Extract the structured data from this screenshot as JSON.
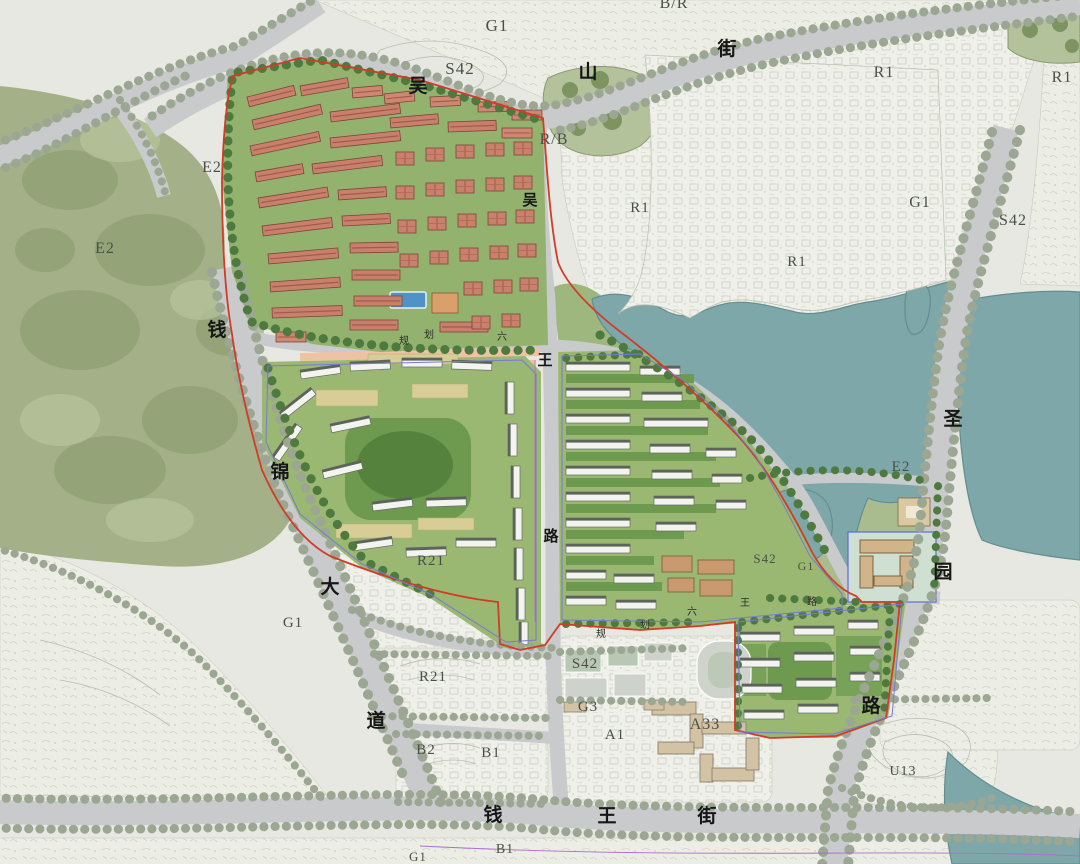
{
  "map": {
    "streets": {
      "top": "吴山街",
      "left": "钱锦大道",
      "bottom": "钱王街",
      "right": "圣园路",
      "central": "吴王路",
      "internal_prefix": "规划",
      "internal": "六王路"
    },
    "colors": {
      "water": "#7ea7a9",
      "water_edge": "#628e91",
      "hill_green": "#a4b188",
      "hill_dark": "#87996c",
      "dev_green": "#92b26e",
      "courtyard_green": "#6d9a4f",
      "tree_dark": "#4e7a3f",
      "tree_road": "#9ba792",
      "red_roof": "#c8806c",
      "red_roof_dark": "#7c4537",
      "white_building": "#f3f4f0",
      "slab_edge": "#5c635a",
      "road": "#c9cacc",
      "fabric": "#eceee6",
      "salmon_road": "#efc2a3",
      "tan_building": "#d2bc93",
      "boundary_red": "#d23b28",
      "parcel_blue": "#7878d8",
      "parcel_magenta": "#b06ad0",
      "pool_blue": "#4f92c8"
    }
  },
  "zone_labels": [
    {
      "text": "G1",
      "x": 497,
      "y": 31,
      "fs": 17
    },
    {
      "text": "S42",
      "x": 460,
      "y": 74,
      "fs": 17
    },
    {
      "text": "B/R",
      "x": 674,
      "y": 8,
      "fs": 16
    },
    {
      "text": "R/B",
      "x": 554,
      "y": 144,
      "fs": 16
    },
    {
      "text": "R1",
      "x": 640,
      "y": 212,
      "fs": 15
    },
    {
      "text": "R1",
      "x": 797,
      "y": 266,
      "fs": 15
    },
    {
      "text": "R1",
      "x": 884,
      "y": 77,
      "fs": 16
    },
    {
      "text": "R1",
      "x": 1062,
      "y": 82,
      "fs": 16
    },
    {
      "text": "G1",
      "x": 920,
      "y": 207,
      "fs": 16
    },
    {
      "text": "S42",
      "x": 1013,
      "y": 225,
      "fs": 16
    },
    {
      "text": "E2",
      "x": 212,
      "y": 172,
      "fs": 16
    },
    {
      "text": "E2",
      "x": 105,
      "y": 253,
      "fs": 16
    },
    {
      "text": "E2",
      "x": 901,
      "y": 471,
      "fs": 15
    },
    {
      "text": "R21",
      "x": 431,
      "y": 565,
      "fs": 15
    },
    {
      "text": "R21",
      "x": 433,
      "y": 681,
      "fs": 15
    },
    {
      "text": "G1",
      "x": 293,
      "y": 627,
      "fs": 15
    },
    {
      "text": "B2",
      "x": 426,
      "y": 754,
      "fs": 15
    },
    {
      "text": "B1",
      "x": 491,
      "y": 757,
      "fs": 15
    },
    {
      "text": "B1",
      "x": 505,
      "y": 853,
      "fs": 14
    },
    {
      "text": "G1",
      "x": 418,
      "y": 861,
      "fs": 13
    },
    {
      "text": "S42",
      "x": 585,
      "y": 668,
      "fs": 15
    },
    {
      "text": "G3",
      "x": 588,
      "y": 711,
      "fs": 15
    },
    {
      "text": "A1",
      "x": 615,
      "y": 739,
      "fs": 15
    },
    {
      "text": "A33",
      "x": 705,
      "y": 729,
      "fs": 16
    },
    {
      "text": "S42",
      "x": 765,
      "y": 563,
      "fs": 13
    },
    {
      "text": "G1",
      "x": 806,
      "y": 570,
      "fs": 12
    },
    {
      "text": "U13",
      "x": 903,
      "y": 775,
      "fs": 14
    }
  ],
  "street_labels": [
    {
      "text": "吴",
      "x": 418,
      "y": 92,
      "fs": 19
    },
    {
      "text": "山",
      "x": 588,
      "y": 78,
      "fs": 19
    },
    {
      "text": "街",
      "x": 727,
      "y": 55,
      "fs": 19
    },
    {
      "text": "钱",
      "x": 217,
      "y": 336,
      "fs": 19
    },
    {
      "text": "锦",
      "x": 280,
      "y": 478,
      "fs": 19
    },
    {
      "text": "大",
      "x": 330,
      "y": 593,
      "fs": 19
    },
    {
      "text": "道",
      "x": 376,
      "y": 727,
      "fs": 19
    },
    {
      "text": "钱",
      "x": 493,
      "y": 821,
      "fs": 19
    },
    {
      "text": "王",
      "x": 607,
      "y": 822,
      "fs": 19
    },
    {
      "text": "街",
      "x": 707,
      "y": 822,
      "fs": 19
    },
    {
      "text": "圣",
      "x": 953,
      "y": 425,
      "fs": 19
    },
    {
      "text": "园",
      "x": 943,
      "y": 578,
      "fs": 19
    },
    {
      "text": "路",
      "x": 871,
      "y": 712,
      "fs": 19
    },
    {
      "text": "吴",
      "x": 530,
      "y": 205,
      "fs": 15
    },
    {
      "text": "王",
      "x": 545,
      "y": 365,
      "fs": 15
    },
    {
      "text": "路",
      "x": 551,
      "y": 541,
      "fs": 15
    }
  ],
  "minor_labels": [
    {
      "text": "规",
      "x": 404,
      "y": 344,
      "fs": 10
    },
    {
      "text": "划",
      "x": 429,
      "y": 338,
      "fs": 10
    },
    {
      "text": "六",
      "x": 502,
      "y": 340,
      "fs": 10
    },
    {
      "text": "规",
      "x": 601,
      "y": 637,
      "fs": 10
    },
    {
      "text": "划",
      "x": 645,
      "y": 628,
      "fs": 10
    },
    {
      "text": "六",
      "x": 692,
      "y": 615,
      "fs": 10
    },
    {
      "text": "王",
      "x": 745,
      "y": 606,
      "fs": 10
    },
    {
      "text": "路",
      "x": 812,
      "y": 605,
      "fs": 10
    }
  ]
}
